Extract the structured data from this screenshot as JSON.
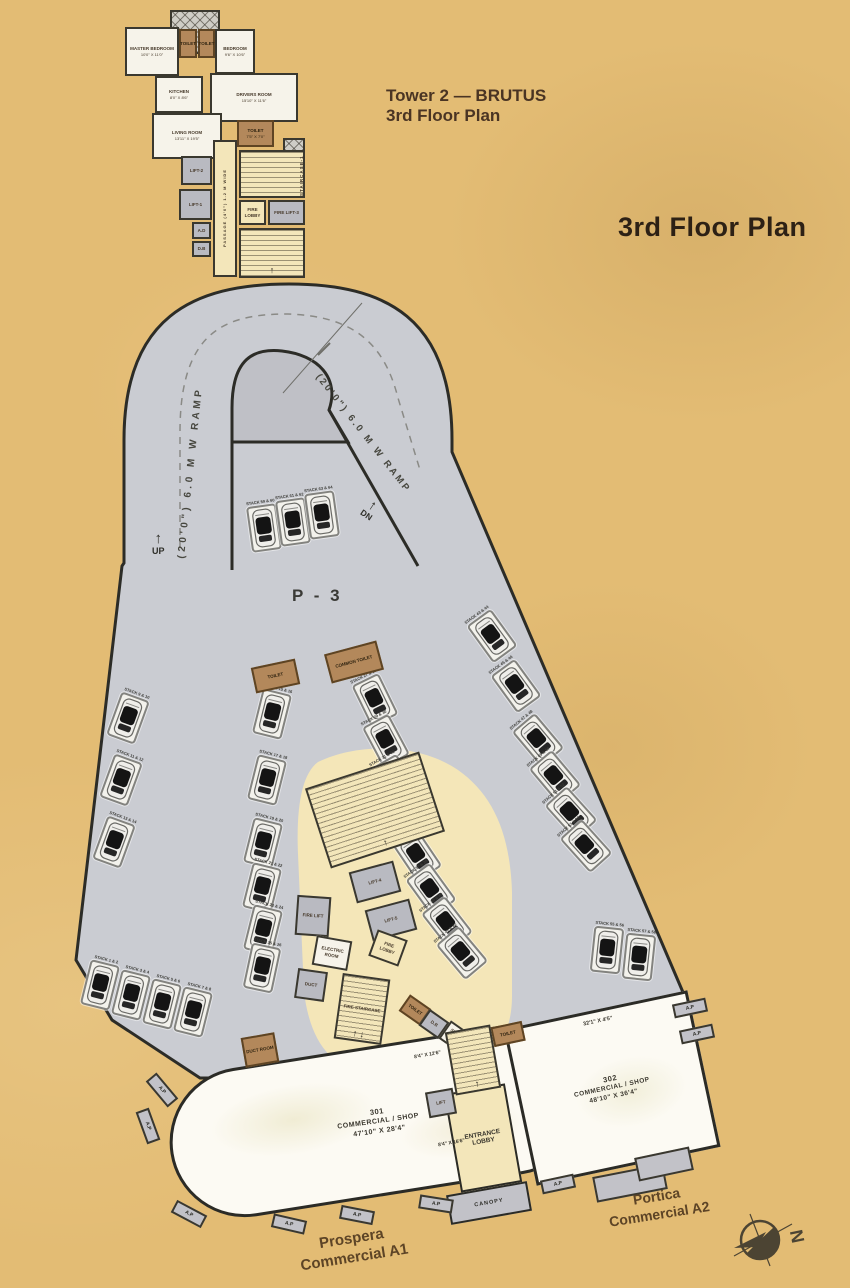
{
  "titles": {
    "tower_line1": "Tower 2 — BRUTUS",
    "tower_line2": "3rd Floor Plan",
    "main": "3rd Floor Plan"
  },
  "labels": {
    "p3": "P - 3",
    "ramp_left": "(20'0\") 6.0 M W RAMP",
    "ramp_right": "(20'0\") 6.0 M W RAMP",
    "up": "UP",
    "dn": "DN",
    "arrow_up": "↑",
    "north": "N",
    "ap": "A.P",
    "canopy": "CANOPY",
    "staircase1": "STAIRCASE-1",
    "prospera_line1": "Prospera",
    "prospera_line2": "Commercial A1",
    "portica_line1": "Portica",
    "portica_line2": "Commercial A2"
  },
  "rooms": [
    {
      "name": "machine-room",
      "label": "",
      "x": 170,
      "y": 10,
      "w": 50,
      "h": 44,
      "cls": "gray2 hatchX"
    },
    {
      "name": "master-bedroom",
      "label": "MASTER BEDROOM",
      "dim": "10'0\" X 11'0\"",
      "x": 125,
      "y": 27,
      "w": 54,
      "h": 49
    },
    {
      "name": "toilet-1",
      "label": "TOILET",
      "x": 179,
      "y": 29,
      "w": 18,
      "h": 29,
      "cls": "brown"
    },
    {
      "name": "toilet-2",
      "label": "TOILET",
      "x": 198,
      "y": 29,
      "w": 17,
      "h": 29,
      "cls": "brown"
    },
    {
      "name": "bedroom",
      "label": "BEDROOM",
      "dim": "9'6\" X 10'6\"",
      "x": 215,
      "y": 29,
      "w": 40,
      "h": 45
    },
    {
      "name": "kitchen",
      "label": "KITCHEN",
      "dim": "8'0\" X 8'6\"",
      "x": 155,
      "y": 76,
      "w": 48,
      "h": 37
    },
    {
      "name": "drivers-room",
      "label": "DRIVERS ROOM",
      "dim": "15'10\" X 11'6\"",
      "x": 210,
      "y": 73,
      "w": 88,
      "h": 49
    },
    {
      "name": "living-room",
      "label": "LIVING ROOM",
      "dim": "13'11\" X 19'5\"",
      "x": 152,
      "y": 113,
      "w": 70,
      "h": 46
    },
    {
      "name": "toilet-3",
      "label": "TOILET",
      "dim": "7'5\" X 7'0\"",
      "x": 237,
      "y": 120,
      "w": 37,
      "h": 27,
      "cls": "brown"
    },
    {
      "name": "passage",
      "label": "PASSAGE (4'0\") 1.2 M WIDE",
      "x": 213,
      "y": 140,
      "w": 24,
      "h": 137,
      "cls": "cream vert"
    },
    {
      "name": "lift-2",
      "label": "LIFT-2",
      "x": 181,
      "y": 156,
      "w": 31,
      "h": 29,
      "cls": "gray"
    },
    {
      "name": "lift-1",
      "label": "LIFT-1",
      "x": 179,
      "y": 189,
      "w": 33,
      "h": 31,
      "cls": "gray"
    },
    {
      "name": "ad-duct",
      "label": "A.D",
      "x": 192,
      "y": 222,
      "w": 19,
      "h": 17,
      "cls": "gray"
    },
    {
      "name": "db-duct",
      "label": "D.B",
      "x": 192,
      "y": 241,
      "w": 19,
      "h": 16,
      "cls": "gray"
    },
    {
      "name": "staircase-1",
      "label": "",
      "x": 239,
      "y": 150,
      "w": 66,
      "h": 48,
      "cls": "cream hatchH"
    },
    {
      "name": "stair-landing",
      "label": "",
      "x": 283,
      "y": 138,
      "w": 22,
      "h": 14,
      "cls": "gray2 hatchX"
    },
    {
      "name": "fire-lobby-top",
      "label": "FIRE LOBBY",
      "x": 239,
      "y": 200,
      "w": 27,
      "h": 25,
      "cls": "cream"
    },
    {
      "name": "fire-lift-3",
      "label": "FIRE LIFT-3",
      "x": 268,
      "y": 200,
      "w": 37,
      "h": 25,
      "cls": "gray"
    },
    {
      "name": "fire-staircase-top",
      "label": "",
      "x": 239,
      "y": 228,
      "w": 66,
      "h": 50,
      "cls": "cream hatchH",
      "arrow": "up"
    },
    {
      "name": "toilet-p3",
      "label": "TOILET",
      "x": 253,
      "y": 663,
      "w": 45,
      "h": 26,
      "cls": "brown",
      "r": -12
    },
    {
      "name": "common-toilet",
      "label": "COMMON TOILET",
      "x": 327,
      "y": 647,
      "w": 54,
      "h": 30,
      "cls": "brown",
      "r": -15
    },
    {
      "name": "main-staircase",
      "label": "",
      "x": 315,
      "y": 768,
      "w": 120,
      "h": 84,
      "cls": "cream hatchH",
      "r": -18,
      "arrow": "up"
    },
    {
      "name": "lift-4",
      "label": "LIFT-4",
      "x": 352,
      "y": 866,
      "w": 46,
      "h": 32,
      "cls": "gray",
      "r": -15
    },
    {
      "name": "lift-5",
      "label": "LIFT-5",
      "x": 368,
      "y": 904,
      "w": 46,
      "h": 32,
      "cls": "gray",
      "r": -15
    },
    {
      "name": "fire-lift",
      "label": "FIRE LIFT",
      "x": 296,
      "y": 896,
      "w": 34,
      "h": 40,
      "cls": "gray",
      "r": 4
    },
    {
      "name": "electric-room",
      "label": "ELECTRIC ROOM",
      "x": 314,
      "y": 938,
      "w": 36,
      "h": 30,
      "r": 10
    },
    {
      "name": "duct-room-1",
      "label": "DUCT",
      "x": 296,
      "y": 970,
      "w": 30,
      "h": 30,
      "cls": "gray",
      "r": 8
    },
    {
      "name": "fire-lobby-2",
      "label": "FIRE LOBBY",
      "x": 372,
      "y": 934,
      "w": 32,
      "h": 28,
      "cls": "cream",
      "r": 20
    },
    {
      "name": "fire-staircase-2",
      "label": "FIRE STAIRCASE",
      "x": 338,
      "y": 976,
      "w": 48,
      "h": 66,
      "cls": "cream hatchH",
      "r": 8,
      "arrow": "updn"
    },
    {
      "name": "toilet-s",
      "label": "TOILET",
      "x": 402,
      "y": 1000,
      "w": 26,
      "h": 20,
      "cls": "brown",
      "r": 35
    },
    {
      "name": "db-2",
      "label": "D.B",
      "x": 422,
      "y": 1014,
      "w": 24,
      "h": 20,
      "cls": "gray",
      "r": 35
    },
    {
      "name": "service-area",
      "label": "SERVICE AREA",
      "x": 442,
      "y": 1027,
      "w": 30,
      "h": 22,
      "r": 35
    },
    {
      "name": "fire-duct",
      "label": "FIRE DUCT",
      "x": 465,
      "y": 1040,
      "w": 24,
      "h": 20,
      "cls": "gray",
      "r": 35
    },
    {
      "name": "toilet-r",
      "label": "TOILET",
      "x": 492,
      "y": 1024,
      "w": 32,
      "h": 20,
      "cls": "brown",
      "r": -12
    },
    {
      "name": "duct-room-2",
      "label": "DUCT ROOM",
      "x": 243,
      "y": 1035,
      "w": 34,
      "h": 30,
      "cls": "brown",
      "r": -10
    },
    {
      "name": "entry-staircase",
      "label": "",
      "x": 450,
      "y": 1028,
      "w": 46,
      "h": 64,
      "cls": "cream hatchH",
      "r": -10,
      "arrow": "up"
    },
    {
      "name": "lift-c",
      "label": "LIFT",
      "x": 427,
      "y": 1090,
      "w": 28,
      "h": 26,
      "cls": "gray",
      "r": -10
    }
  ],
  "parking": {
    "stalls": [
      {
        "x": 100,
        "y": 985,
        "r": 14,
        "label": "STACK 1 & 2"
      },
      {
        "x": 131,
        "y": 995,
        "r": 14,
        "label": "STACK 3 & 4"
      },
      {
        "x": 162,
        "y": 1004,
        "r": 14,
        "label": "STACK 5 & 6"
      },
      {
        "x": 193,
        "y": 1012,
        "r": 14,
        "label": "STACK 7 & 8"
      },
      {
        "x": 128,
        "y": 718,
        "r": 20,
        "label": "STACK 9 & 10"
      },
      {
        "x": 121,
        "y": 780,
        "r": 20,
        "label": "STACK 11 & 12"
      },
      {
        "x": 114,
        "y": 842,
        "r": 20,
        "label": "STACK 13 & 14"
      },
      {
        "x": 272,
        "y": 714,
        "r": 14,
        "label": "STACK 15 & 16"
      },
      {
        "x": 267,
        "y": 780,
        "r": 14,
        "label": "STACK 17 & 18"
      },
      {
        "x": 263,
        "y": 843,
        "r": 14,
        "label": "STACK 19 & 20"
      },
      {
        "x": 262,
        "y": 888,
        "r": 14,
        "label": "STACK 21 & 22"
      },
      {
        "x": 263,
        "y": 930,
        "r": 14,
        "label": "STACK 23 & 24"
      },
      {
        "x": 262,
        "y": 968,
        "r": 12,
        "label": "STACK 25 & 26"
      },
      {
        "x": 375,
        "y": 700,
        "r": -26,
        "label": "STACK 27 & 28"
      },
      {
        "x": 386,
        "y": 741,
        "r": -28,
        "label": "STACK 29 & 30"
      },
      {
        "x": 395,
        "y": 781,
        "r": -30,
        "label": "STACK 31 & 32"
      },
      {
        "x": 406,
        "y": 818,
        "r": -32,
        "label": "STACK 33 & 34"
      },
      {
        "x": 417,
        "y": 855,
        "r": -34,
        "label": "STACK 35 & 36"
      },
      {
        "x": 431,
        "y": 890,
        "r": -36,
        "label": "STACK 37 & 38"
      },
      {
        "x": 447,
        "y": 923,
        "r": -38,
        "label": "STACK 39 & 40"
      },
      {
        "x": 462,
        "y": 953,
        "r": -40,
        "label": "STACK 41 & 42"
      },
      {
        "x": 492,
        "y": 636,
        "r": -36,
        "label": "STACK 43 & 44"
      },
      {
        "x": 516,
        "y": 686,
        "r": -36,
        "label": "STACK 45 & 46"
      },
      {
        "x": 538,
        "y": 740,
        "r": -40,
        "label": "STACK 47 & 48"
      },
      {
        "x": 555,
        "y": 777,
        "r": -40,
        "label": "STACK 49 & 50"
      },
      {
        "x": 571,
        "y": 813,
        "r": -42,
        "label": "STACK 51 & 52"
      },
      {
        "x": 586,
        "y": 846,
        "r": -42,
        "label": "STACK 53 & 54"
      },
      {
        "x": 607,
        "y": 950,
        "r": 6,
        "label": "STACK 55 & 56"
      },
      {
        "x": 639,
        "y": 957,
        "r": 6,
        "label": "STACK 57 & 58"
      },
      {
        "x": 264,
        "y": 528,
        "r": -8,
        "label": "STACK 59 & 60"
      },
      {
        "x": 293,
        "y": 522,
        "r": -8,
        "label": "STACK 61 & 62"
      },
      {
        "x": 322,
        "y": 515,
        "r": -8,
        "label": "STACK 63 & 64"
      }
    ]
  },
  "commercial": {
    "c301": {
      "num": "301",
      "type": "COMMERCIAL / SHOP",
      "dim": "47'10\" X 28'4\""
    },
    "c302": {
      "num": "302",
      "type": "COMMERCIAL / SHOP",
      "dim": "48'10\" X 36'4\"",
      "top_dim": "32'1\" X 4'5\""
    },
    "entrance_lobby": "ENTRANCE LOBBY",
    "dims": [
      "8'4\" X 12'6\"",
      "8'4\" X 16'6\""
    ],
    "ap_tabs": [
      {
        "x": 162,
        "y": 1090,
        "r": 50
      },
      {
        "x": 148,
        "y": 1126,
        "r": 70
      },
      {
        "x": 189,
        "y": 1214,
        "r": 28
      },
      {
        "x": 289,
        "y": 1224,
        "r": 13
      },
      {
        "x": 357,
        "y": 1215,
        "r": 11
      },
      {
        "x": 436,
        "y": 1204,
        "r": 9
      },
      {
        "x": 558,
        "y": 1184,
        "r": -12
      },
      {
        "x": 690,
        "y": 1008,
        "r": -12
      },
      {
        "x": 697,
        "y": 1034,
        "r": -12
      }
    ]
  }
}
